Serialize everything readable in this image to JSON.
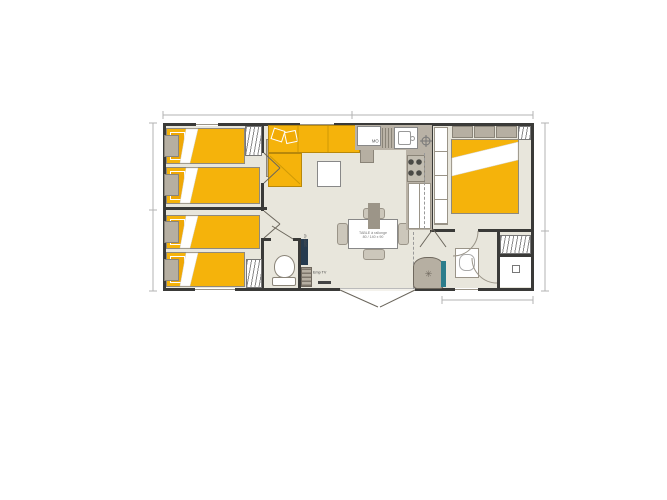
{
  "floorplan": {
    "labels": {
      "microwave": "MO",
      "dining_table_line1": "TABLE à rallonge",
      "dining_table_line2": "80 / 140 x 90",
      "tv_spot": "Emp TV",
      "wall_heater": "1000 W",
      "water_heater_symbol": "✳"
    },
    "colors": {
      "bed_yellow": "#F5B30B",
      "floor": "#E8E6DC",
      "wall": "#3A3A38",
      "furniture_taupe": "#B6AFA2",
      "counter_taupe": "#B9B2A6",
      "heater_navy": "#263B4F",
      "teal_accent": "#2C7D8C",
      "dimension_gray": "#B3B3B3"
    }
  }
}
